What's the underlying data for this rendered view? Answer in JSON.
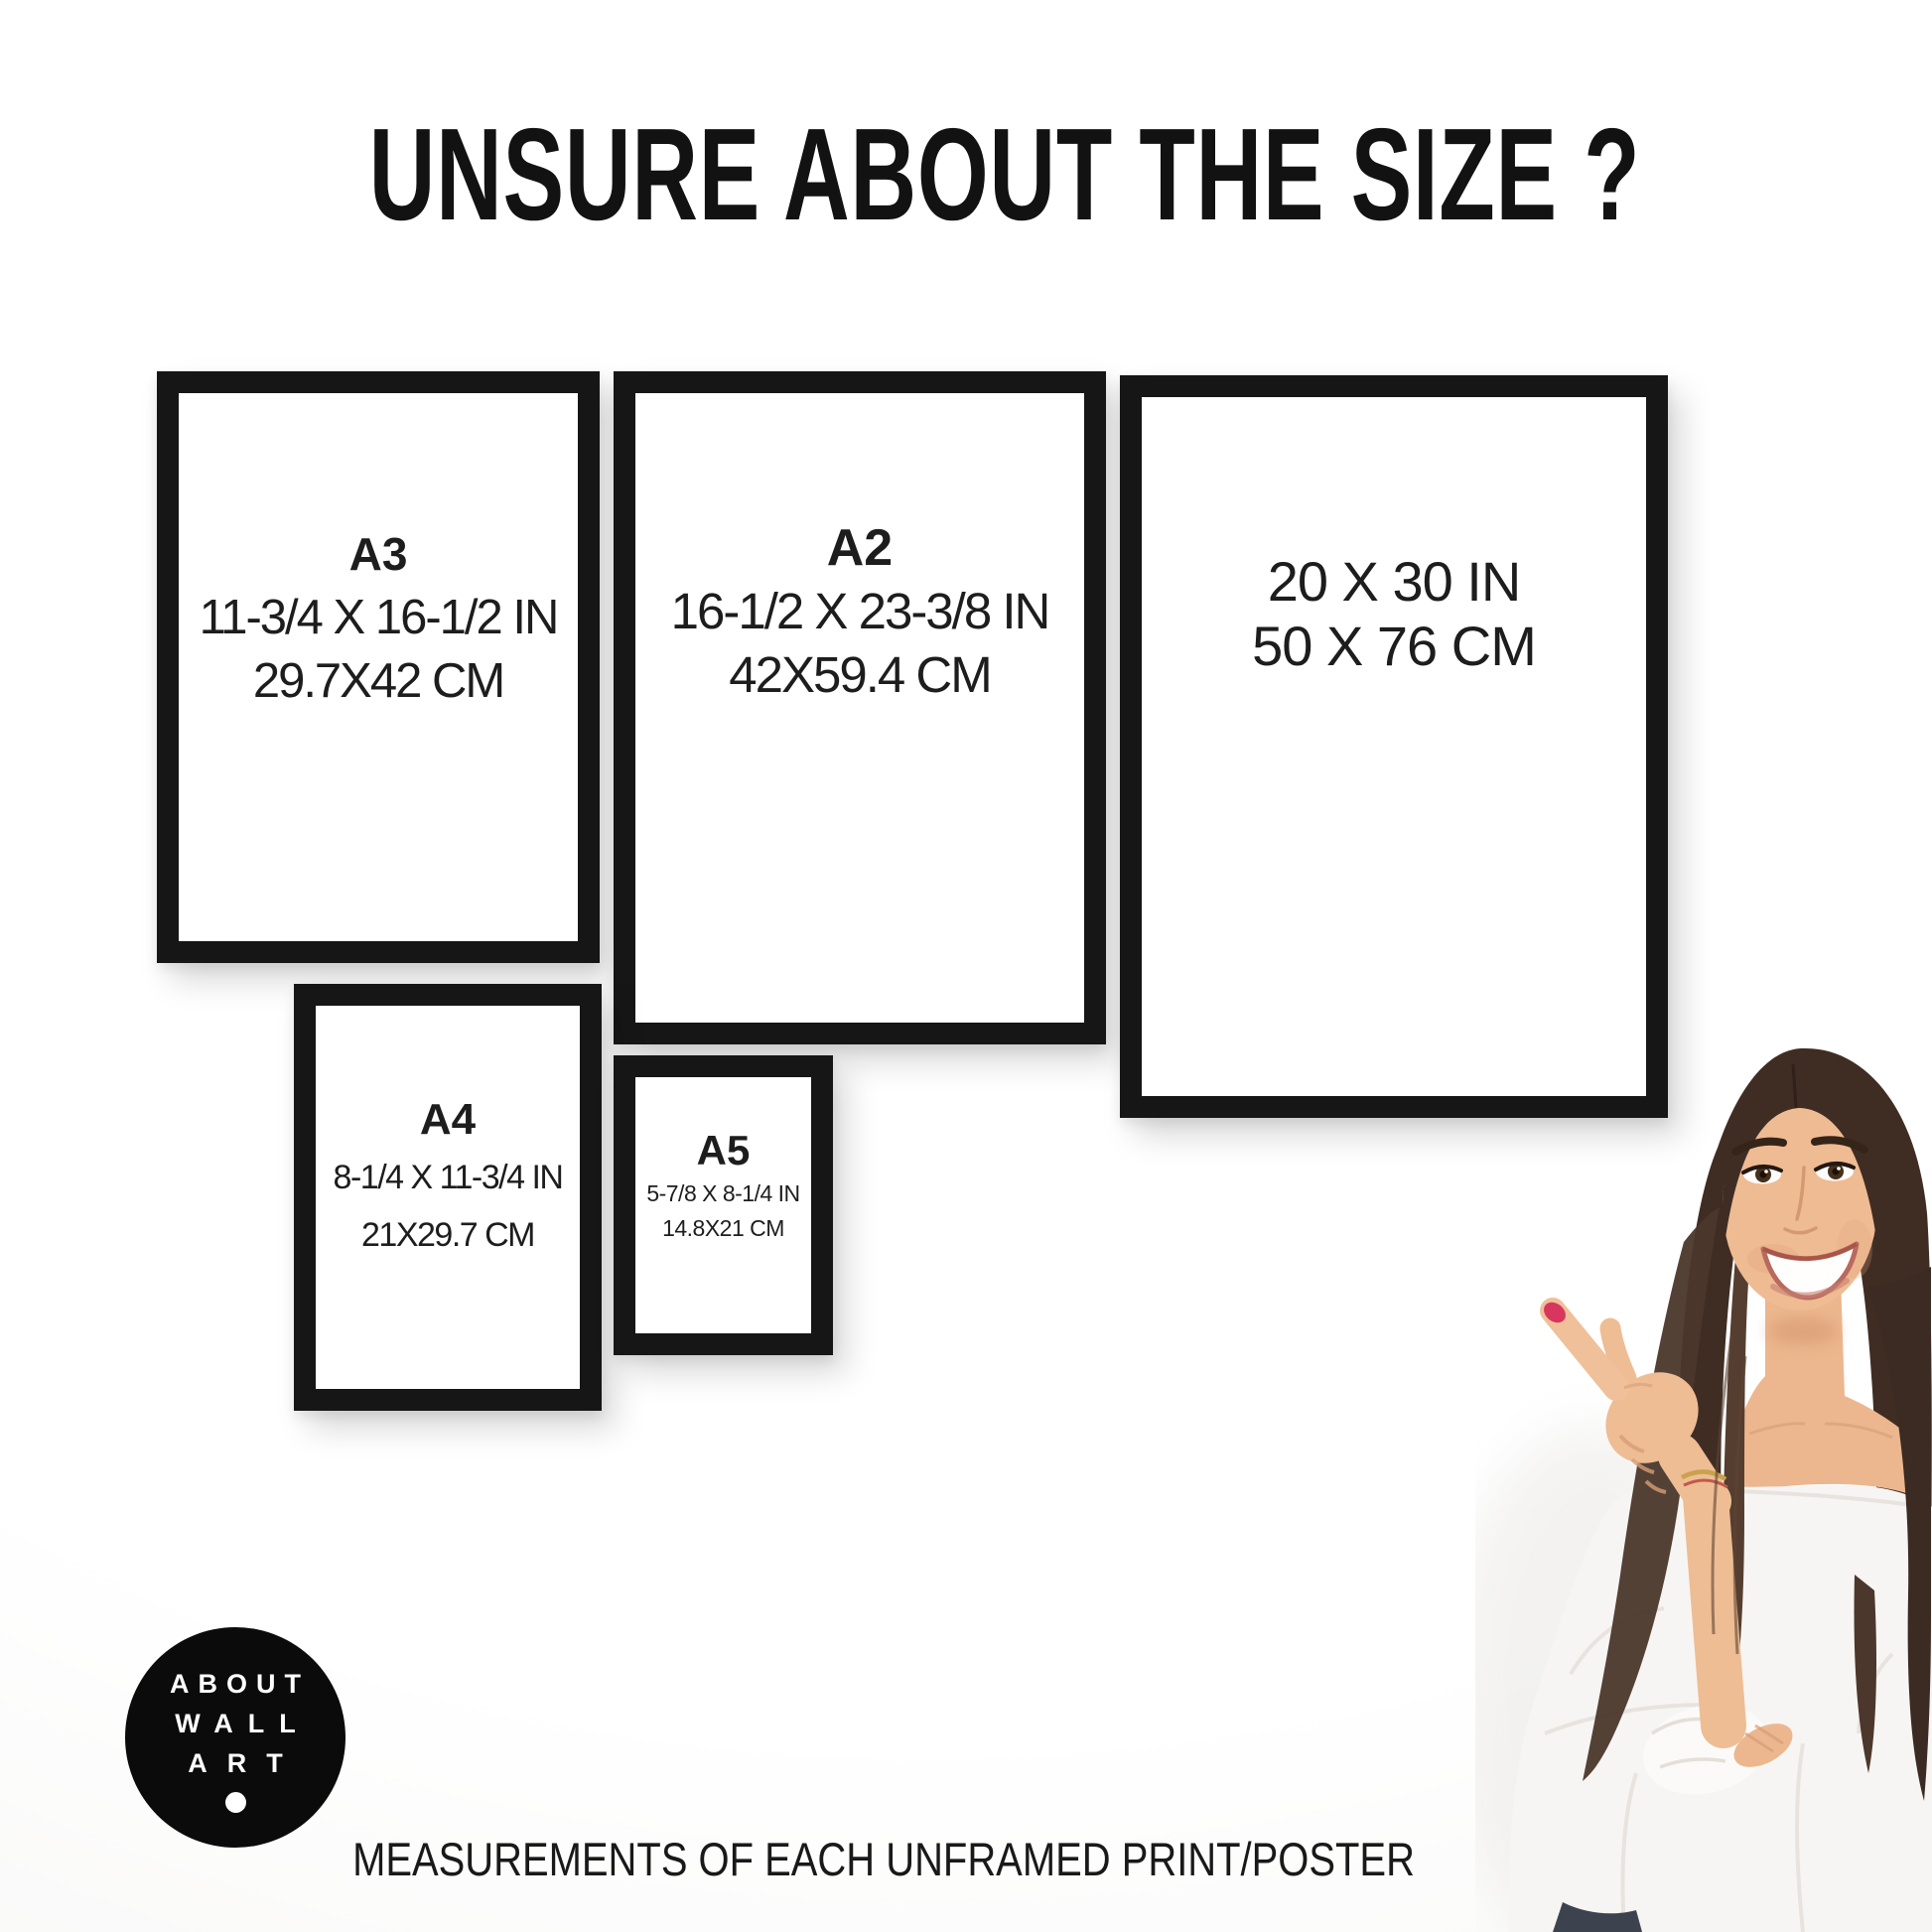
{
  "title": "UNSURE ABOUT THE SIZE ?",
  "caption": "MEASUREMENTS OF EACH UNFRAMED PRINT/POSTER",
  "frames": [
    {
      "name": "A3",
      "size_in": "11-3/4 X 16-1/2 IN",
      "size_cm": "29.7X42 CM"
    },
    {
      "name": "A2",
      "size_in": "16-1/2 X 23-3/8 IN",
      "size_cm": "42X59.4 CM"
    },
    {
      "name": "",
      "size_in": "20 X 30 IN",
      "size_cm": "50 X 76 CM"
    },
    {
      "name": "A4",
      "size_in": "8-1/4 X 11-3/4 IN",
      "size_cm": "21X29.7 CM"
    },
    {
      "name": "A5",
      "size_in": "5-7/8 X 8-1/4 IN",
      "size_cm": "14.8X21 CM"
    }
  ],
  "logo": {
    "lines": [
      "ABOUT",
      "WALL",
      "ART"
    ]
  },
  "colors": {
    "frame_border": "#161616",
    "text": "#1d1d1d",
    "logo_background": "#0b0b0b",
    "logo_text": "#ffffff",
    "background": "#ffffff",
    "nail_polish": "#d8365e"
  }
}
